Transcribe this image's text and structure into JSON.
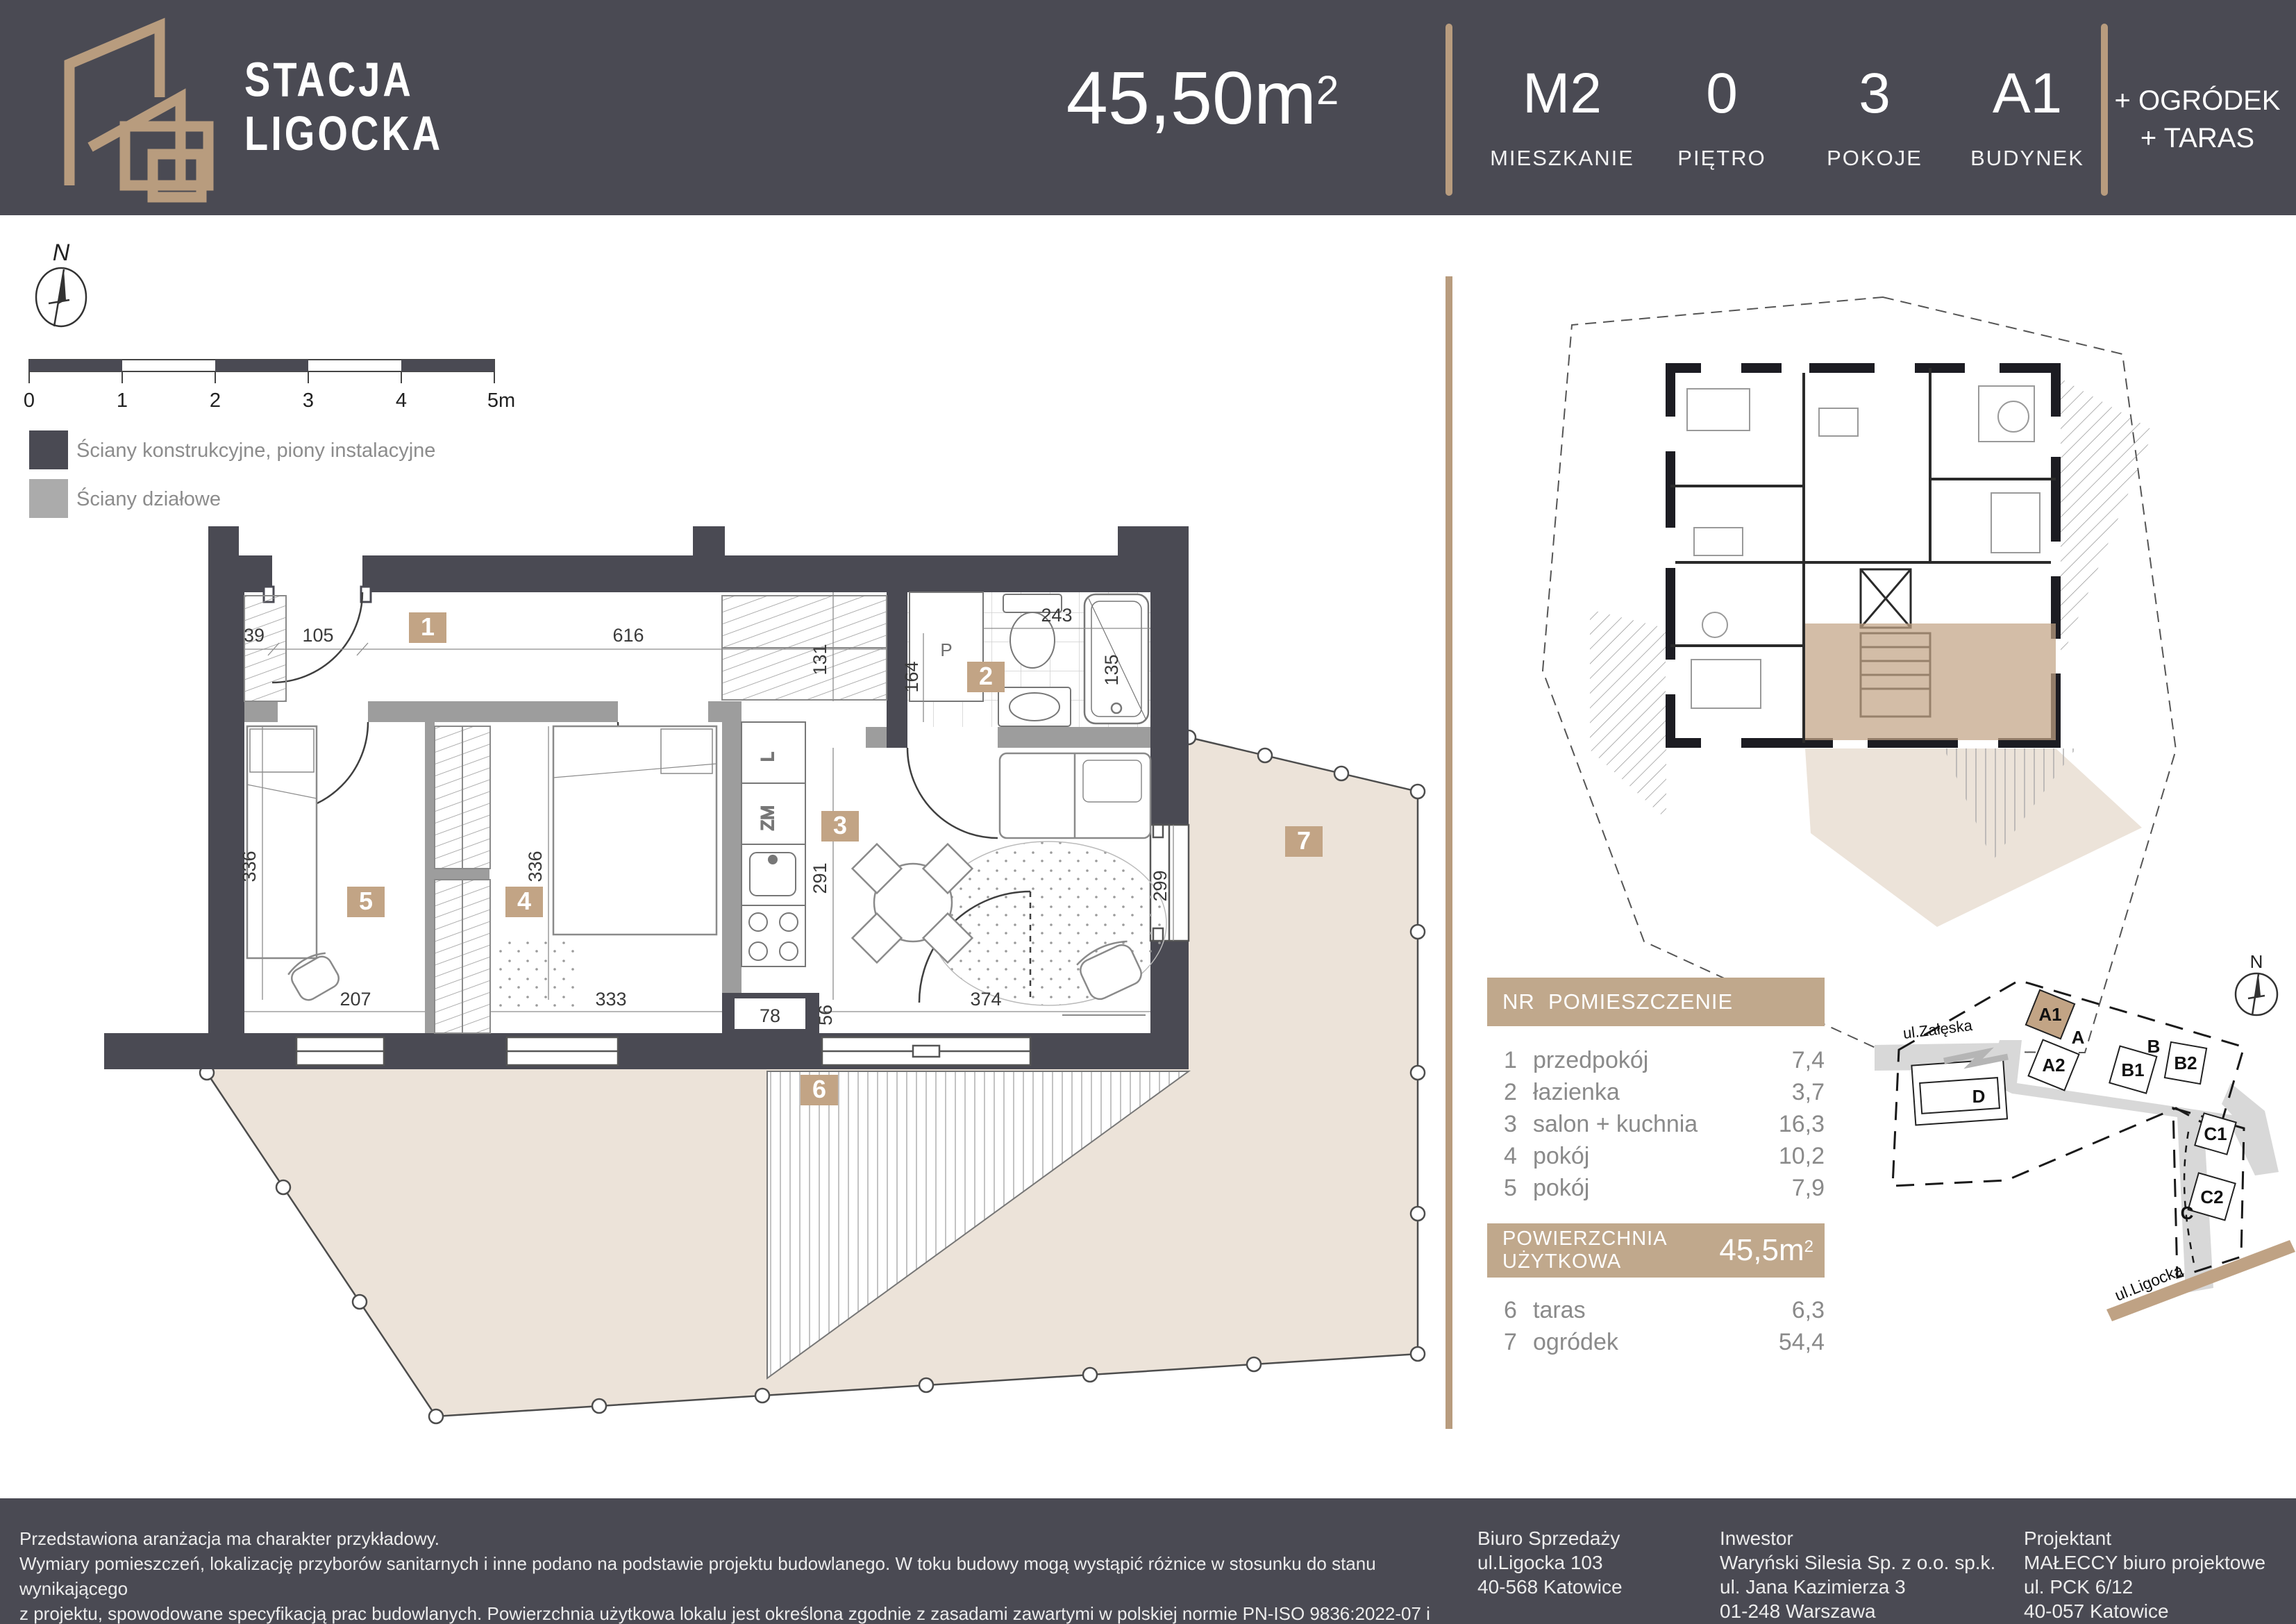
{
  "header": {
    "brand": {
      "line1": "STACJA",
      "line2": "LIGOCKA"
    },
    "area": {
      "value": "45,50m",
      "sup": "2"
    },
    "stats": [
      {
        "value": "M2",
        "label": "MIESZKANIE"
      },
      {
        "value": "0",
        "label": "PIĘTRO"
      },
      {
        "value": "3",
        "label": "POKOJE"
      },
      {
        "value": "A1",
        "label": "BUDYNEK"
      }
    ],
    "extras": {
      "line1": "+ OGRÓDEK",
      "line2": "+ TARAS"
    }
  },
  "legend": {
    "compass": "N",
    "scale_ticks": [
      "0",
      "1",
      "2",
      "3",
      "4",
      "5m"
    ],
    "items": [
      {
        "label": "Ściany konstrukcyjne, piony instalacyjne"
      },
      {
        "label": "Ściany działowe"
      }
    ]
  },
  "floorplan": {
    "chips": [
      "1",
      "2",
      "3",
      "4",
      "5",
      "6",
      "7"
    ],
    "dims": {
      "top39": "39",
      "top105": "105",
      "top616": "616",
      "v131": "131",
      "v164": "164",
      "h243": "243",
      "v135": "135",
      "v291": "291",
      "v299": "299",
      "v336L": "336",
      "v336R": "336",
      "h207": "207",
      "h333": "333",
      "h78": "78",
      "v56": "56",
      "h374": "374"
    },
    "labels": {
      "washer": "P",
      "fridge": "L",
      "dishwasher": "ZM"
    }
  },
  "site_plan": {
    "compass": "N",
    "streets": {
      "zaleska": "ul.Załęska",
      "ligocka": "ul.Ligocka"
    },
    "buildings": {
      "a1": "A1",
      "a": "A",
      "a2": "A2",
      "b": "B",
      "b1": "B1",
      "b2": "B2",
      "c": "C",
      "c1": "C1",
      "c2": "C2",
      "d": "D"
    }
  },
  "room_table": {
    "header": {
      "nr": "NR",
      "name": "POMIESZCZENIE"
    },
    "rows": [
      {
        "nr": "1",
        "name": "przedpokój",
        "area": "7,4"
      },
      {
        "nr": "2",
        "name": "łazienka",
        "area": "3,7"
      },
      {
        "nr": "3",
        "name": "salon + kuchnia",
        "area": "16,3"
      },
      {
        "nr": "4",
        "name": "pokój",
        "area": "10,2"
      },
      {
        "nr": "5",
        "name": "pokój",
        "area": "7,9"
      }
    ],
    "total": {
      "label": "POWIERZCHNIA UŻYTKOWA",
      "value": "45,5m",
      "sup": "2"
    },
    "outdoor_rows": [
      {
        "nr": "6",
        "name": "taras",
        "area": "6,3"
      },
      {
        "nr": "7",
        "name": "ogródek",
        "area": "54,4"
      }
    ]
  },
  "footer": {
    "disclaimer": [
      "Przedstawiona aranżacja ma charakter przykładowy.",
      "Wymiary pomieszczeń, lokalizację przyborów sanitarnych i inne podano na podstawie projektu budowlanego. W toku budowy mogą wystąpić różnice w stosunku do stanu wynikającego",
      "z projektu, spowodowane specyfikacją prac budowlanych. Powierzchnia użytkowa lokalu jest określona zgodnie z zasadami zawartymi w polskiej normie PN-ISO 9836:2022-07 i jest",
      "obliczona w świetle pionowych przegród w stanie wykończonym tynkiem. Do powierzchni użytkowej nie są wliczane powierzchnie przekroju poziomego ścianek działowych."
    ],
    "columns": [
      {
        "title": "Biuro Sprzedaży",
        "l1": "ul.Ligocka 103",
        "l2": "40-568 Katowice",
        "l3": ""
      },
      {
        "title": "Inwestor",
        "l1": "Waryński Silesia Sp. z o.o. sp.k.",
        "l2": "ul. Jana Kazimierza 3",
        "l3": "01-248 Warszawa"
      },
      {
        "title": "Projektant",
        "l1": "MAŁECCY biuro projektowe",
        "l2": "ul. PCK 6/12",
        "l3": "40-057 Katowice"
      }
    ]
  },
  "colors": {
    "dark": "#4a4a53",
    "accent": "#b89c7e",
    "chip": "#c2a485",
    "table_bar": "#c0a88c",
    "garden": "#ece3d9",
    "partition": "#9d9d9d",
    "highlight": "#c9ac8e"
  }
}
